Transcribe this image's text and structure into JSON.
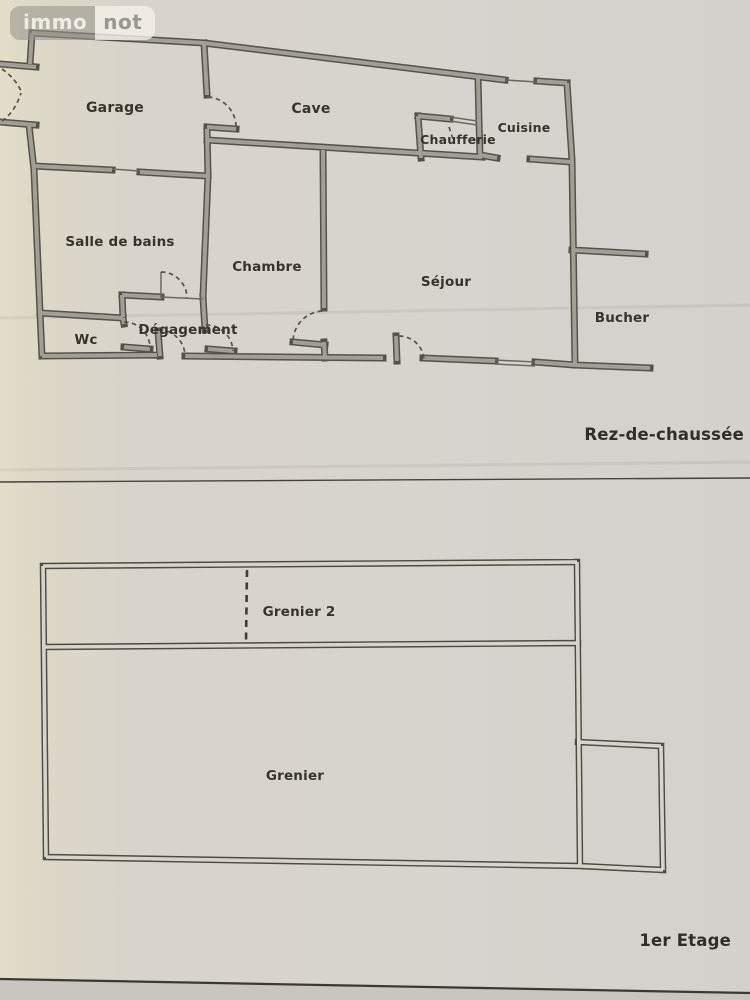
{
  "logo": {
    "immo": "immo",
    "not": "not"
  },
  "floors": [
    {
      "caption": "Rez-de-chaussée",
      "rooms": {
        "garage": "Garage",
        "cave": "Cave",
        "chaufferie": "Chaufferie",
        "cuisine": "Cuisine",
        "salle_de_bains": "Salle de bains",
        "chambre": "Chambre",
        "sejour": "Séjour",
        "bucher": "Bucher",
        "wc": "Wc",
        "degagement": "Dégagement"
      }
    },
    {
      "caption": "1er Etage",
      "rooms": {
        "grenier2": "Grenier 2",
        "grenier": "Grenier"
      }
    }
  ],
  "colors": {
    "paper": "#d7d3cb",
    "wall_edge": "#55524b",
    "wall_fill": "#a29f97",
    "label_text": "#36342c",
    "logo_gray": "#95928b",
    "logo_light": "#f0eee6"
  }
}
